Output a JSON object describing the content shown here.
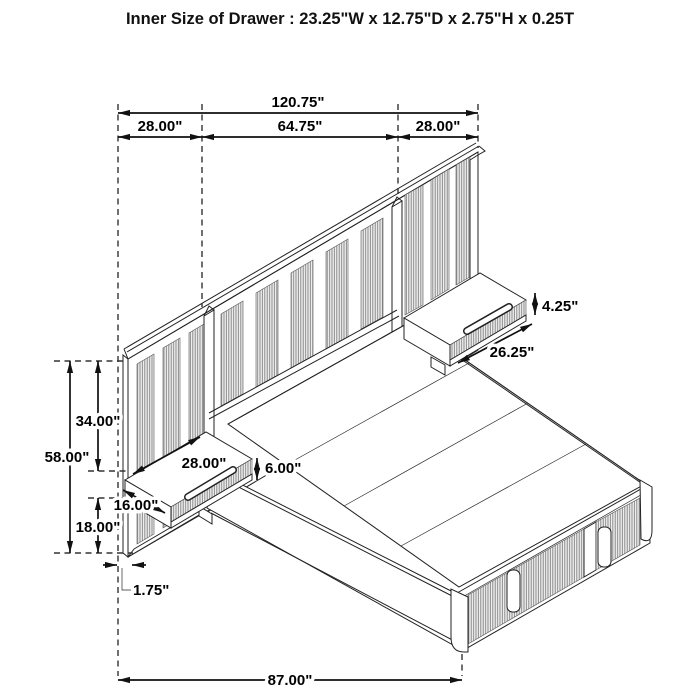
{
  "title": "Inner Size of Drawer : 23.25\"W x 12.75\"D x 2.75\"H x 0.25T",
  "dimensions": {
    "overall_width": "120.75\"",
    "left_section_width": "28.00\"",
    "center_section_width": "64.75\"",
    "right_section_width": "28.00\"",
    "panel_height": "58.00\"",
    "panel_upper_height": "34.00\"",
    "panel_lower_height": "18.00\"",
    "panel_thickness": "1.75\"",
    "bed_length": "87.00\"",
    "nightstand_width": "28.00\"",
    "nightstand_depth": "16.00\"",
    "nightstand_height": "6.00\"",
    "right_nightstand_length": "26.25\"",
    "right_drawer_front_height": "4.25\""
  },
  "colors": {
    "line": "#222222",
    "dimension_line": "#111111",
    "background": "#ffffff",
    "flute_fill": "#f1f1f1",
    "flute_stripe": "#7d7d7d"
  }
}
